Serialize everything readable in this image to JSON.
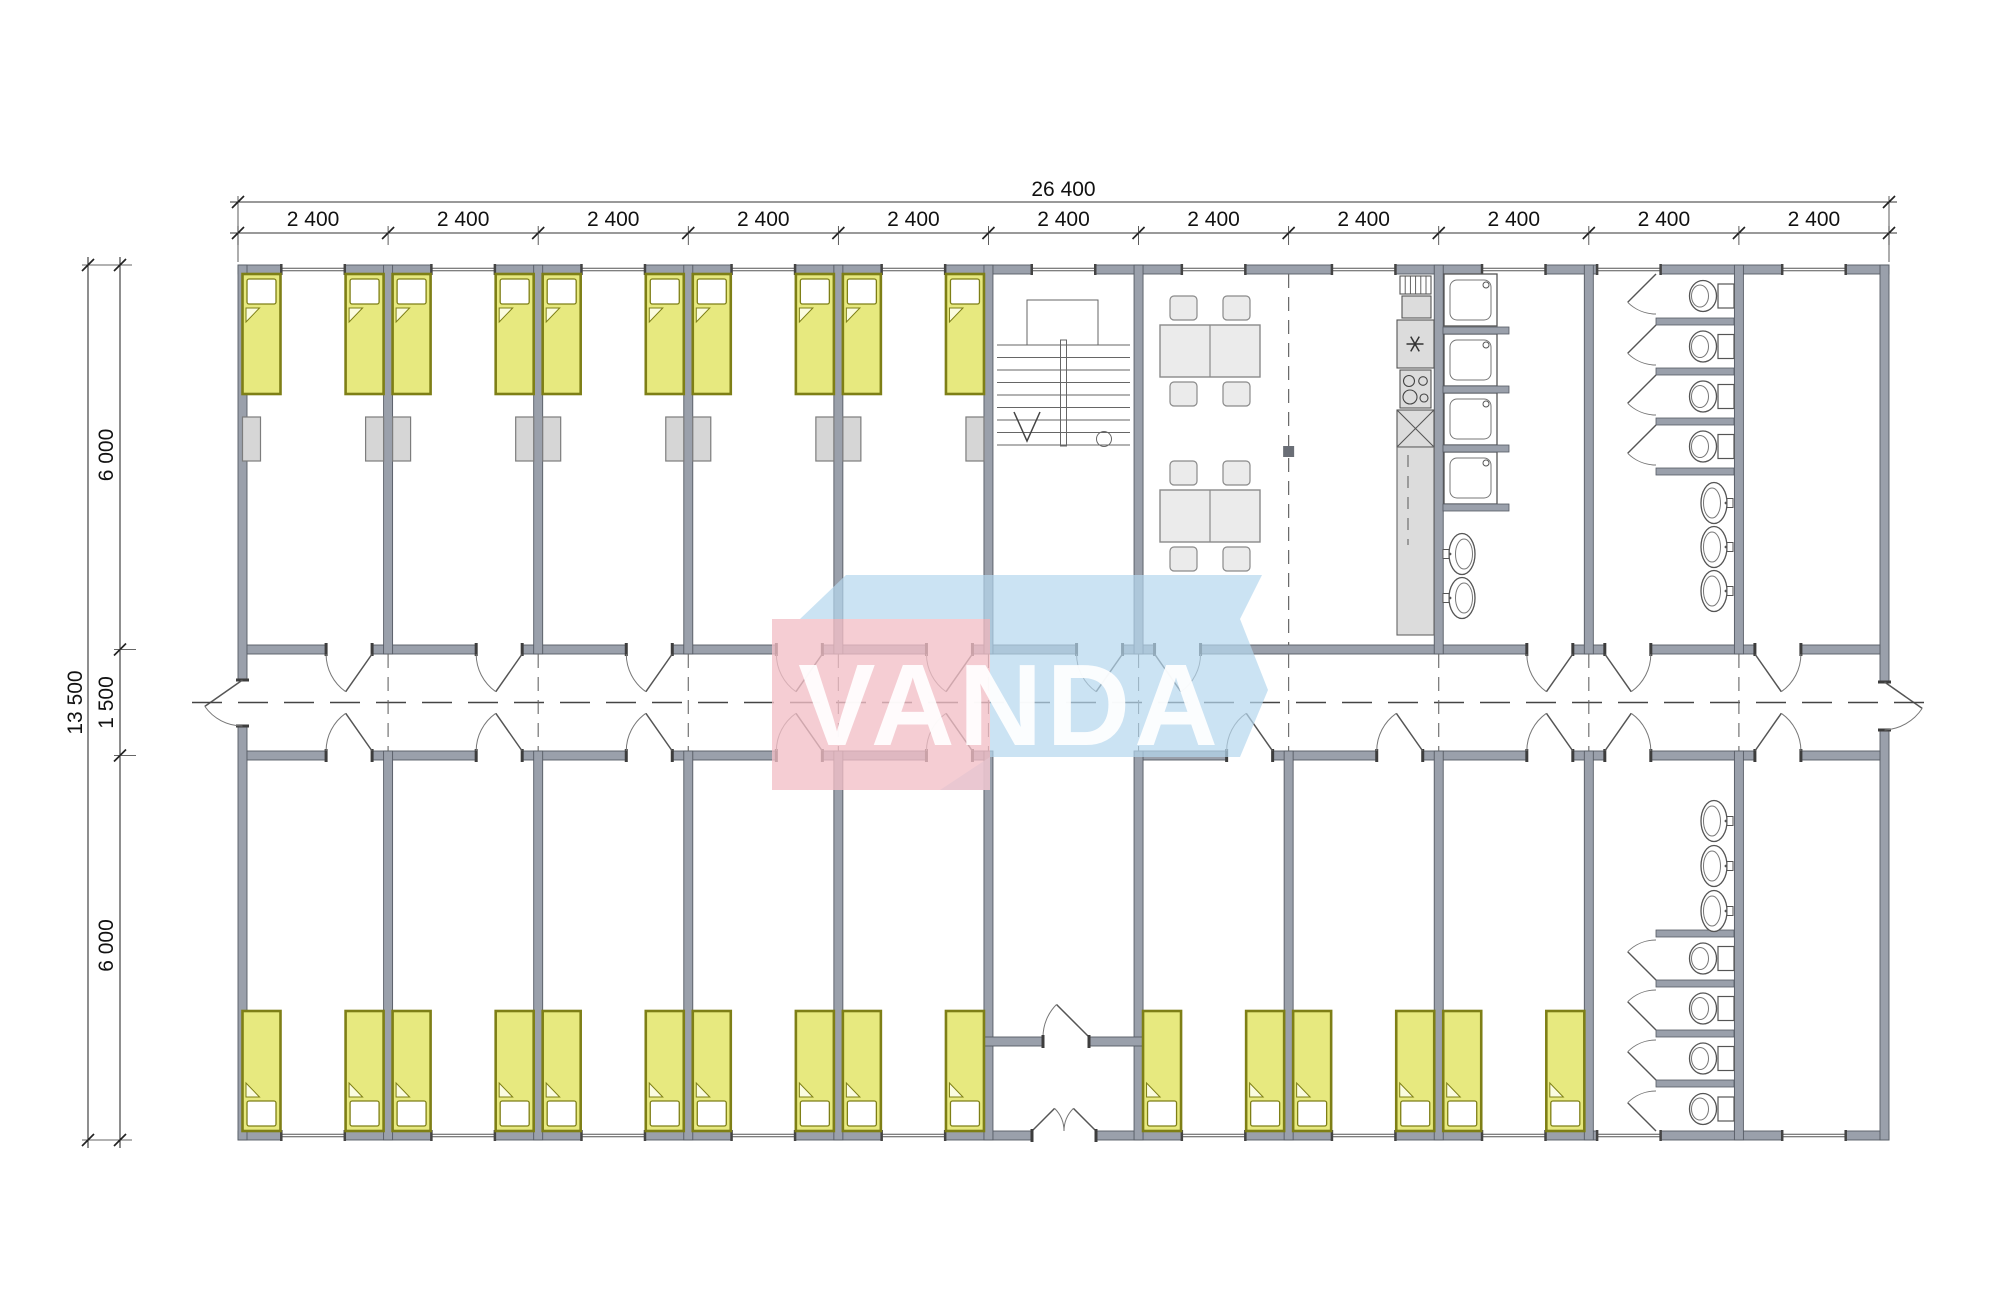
{
  "dimensions": {
    "total_width": "26 400",
    "module_labels": [
      "2 400",
      "2 400",
      "2 400",
      "2 400",
      "2 400",
      "2 400",
      "2 400",
      "2 400",
      "2 400",
      "2 400",
      "2 400"
    ],
    "total_height": "13 500",
    "left_segments": [
      "6 000",
      "1 500",
      "6 000"
    ]
  },
  "watermark": {
    "text": "VANDA",
    "pink": "#f2bfc7",
    "blue": "#b5d7ee",
    "text_color": "#ffffff"
  },
  "plan": {
    "top_row": [
      {
        "type": "bedroom",
        "beds": 2,
        "wardrobes": 2
      },
      {
        "type": "bedroom",
        "beds": 2,
        "wardrobes": 2
      },
      {
        "type": "bedroom",
        "beds": 2,
        "wardrobes": 2
      },
      {
        "type": "bedroom",
        "beds": 2,
        "wardrobes": 2
      },
      {
        "type": "bedroom",
        "beds": 2,
        "wardrobes": 2
      },
      {
        "type": "staircase"
      },
      {
        "type": "dining",
        "span": 2,
        "tables": 2,
        "chairs_per_table": 4,
        "kitchen_units": [
          "hood",
          "oven",
          "fridge",
          "stove",
          "sink",
          "counter"
        ]
      },
      {
        "type": "washroom",
        "showers": 4,
        "basins": 2
      },
      {
        "type": "toilets",
        "stalls": 4,
        "basins": 3
      },
      {
        "type": "empty"
      }
    ],
    "bottom_row": [
      {
        "type": "bedroom",
        "beds": 2
      },
      {
        "type": "bedroom",
        "beds": 2
      },
      {
        "type": "bedroom",
        "beds": 2
      },
      {
        "type": "bedroom",
        "beds": 2
      },
      {
        "type": "bedroom",
        "beds": 2
      },
      {
        "type": "entrance",
        "doors": "double"
      },
      {
        "type": "bedroom",
        "beds": 2
      },
      {
        "type": "bedroom",
        "beds": 2
      },
      {
        "type": "bedroom",
        "beds": 2
      },
      {
        "type": "toilets",
        "stalls": 4,
        "basins": 3
      },
      {
        "type": "empty"
      }
    ]
  },
  "colors": {
    "wall": "#9aa0ab",
    "wall_stroke": "#565b64",
    "bed_fill": "#e7e97f",
    "bed_stroke": "#7e7f16",
    "bed_fold": "#fbfce0",
    "furniture_fill": "#ebebeb",
    "furniture_stroke": "#8a8a8a",
    "wardrobe_fill": "#d6d6d6",
    "appliance_fill": "#dcdcdc",
    "line": "#555555",
    "thin_line": "#777777",
    "dim_line": "#333333",
    "dim_text": "#111111",
    "column": "#6a6e76"
  }
}
